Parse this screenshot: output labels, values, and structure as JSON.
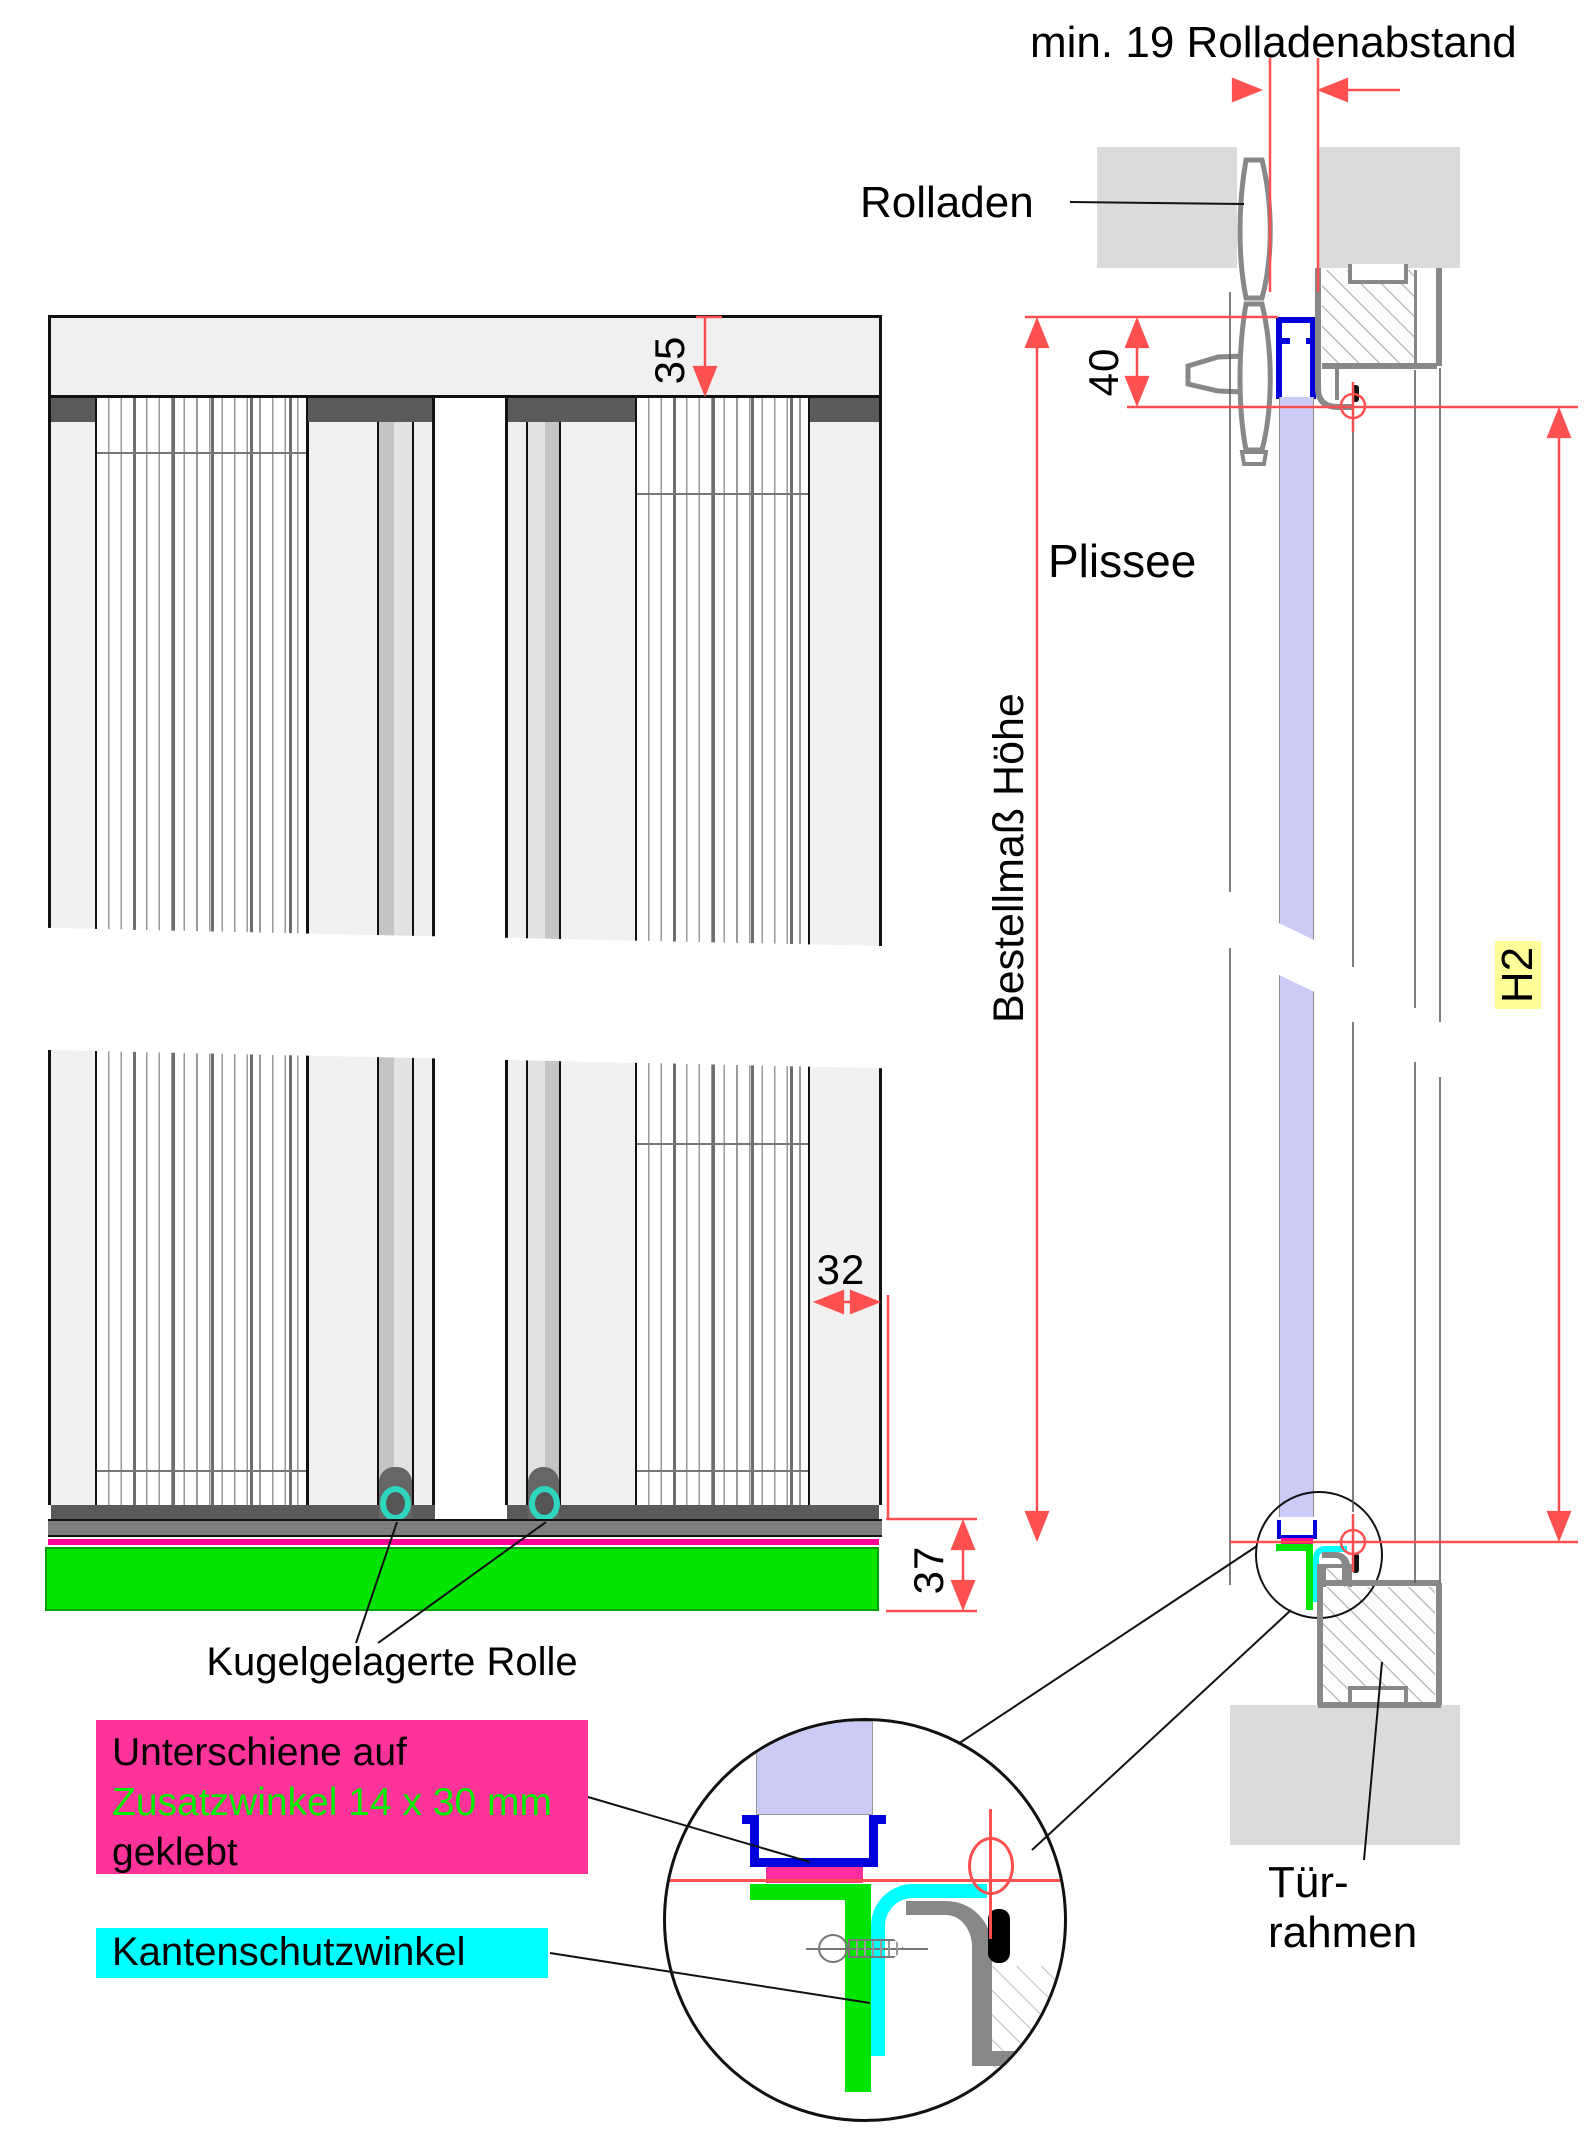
{
  "title": "Plissee Tür – Montagezeichnung",
  "header": {
    "min19": "min. 19 Rolladenabstand"
  },
  "labels": {
    "rolladen": "Rolladen",
    "plissee": "Plissee",
    "bestellmass": "Bestellmaß Höhe",
    "h2": "H2",
    "kugelrolle": "Kugelgelagerte Rolle",
    "tuer1": "Tür-",
    "tuer2": "rahmen"
  },
  "dims": {
    "d35": "35",
    "d40": "40",
    "d32": "32",
    "d37": "37"
  },
  "callouts": {
    "pink1": "Unterschiene auf",
    "pink2": "Zusatzwinkel 14 x 30 mm",
    "pink3": "geklebt",
    "cyan1": "Kantenschutzwinkel"
  },
  "colors": {
    "dimension_red": "#FF5050",
    "green_angle": "#00E400",
    "magenta_tape": "#FF0099",
    "pink_box": "#FF3399",
    "cyan_angle": "#00FFFF",
    "blue_rail": "#0000DD",
    "lavender_fabric": "#CBCBF6",
    "teal_roller": "#2FD6BE",
    "h2_highlight": "#FFFF99",
    "frame_gray": "#888888",
    "wall_gray": "#DBDBDB"
  }
}
